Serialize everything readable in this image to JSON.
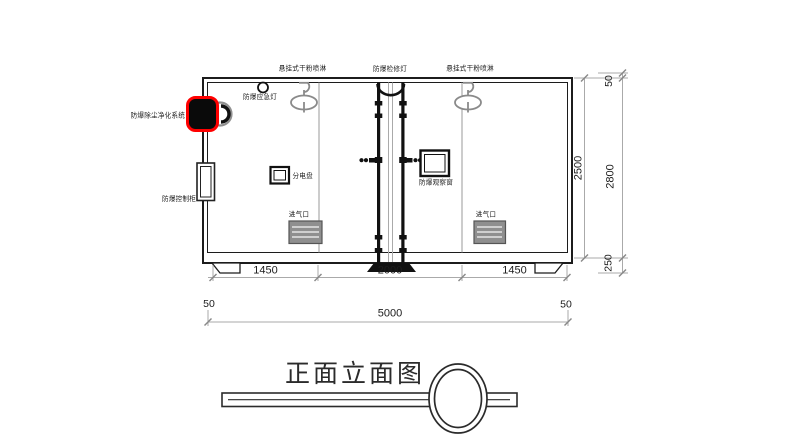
{
  "colors": {
    "dimension_text": "#e60000",
    "highlight_outline": "#ff0000",
    "drawing_line": "#1c1c1c",
    "device_gray": "#8a8a8a"
  },
  "title": {
    "text": "正面立面图"
  },
  "labels": {
    "spray_left": "悬挂式干粉喷淋",
    "inspection_light": "防爆检修灯",
    "spray_right": "悬挂式干粉喷淋",
    "emergency_light": "防爆应急灯",
    "purification_system": "防爆除尘净化系统",
    "control_cabinet": "防爆控制柜",
    "distribution_panel": "分电盘",
    "observation_window": "防爆观察窗",
    "air_inlet_left": "进气口",
    "air_inlet_right": "进气口"
  },
  "dimensions": {
    "width_segments": [
      "1450",
      "2000",
      "1450"
    ],
    "width_margin_left": "50",
    "width_total": "5000",
    "width_margin_right": "50",
    "height_body": "2500",
    "height_roof": "50",
    "height_total": "2800",
    "height_base": "250"
  }
}
